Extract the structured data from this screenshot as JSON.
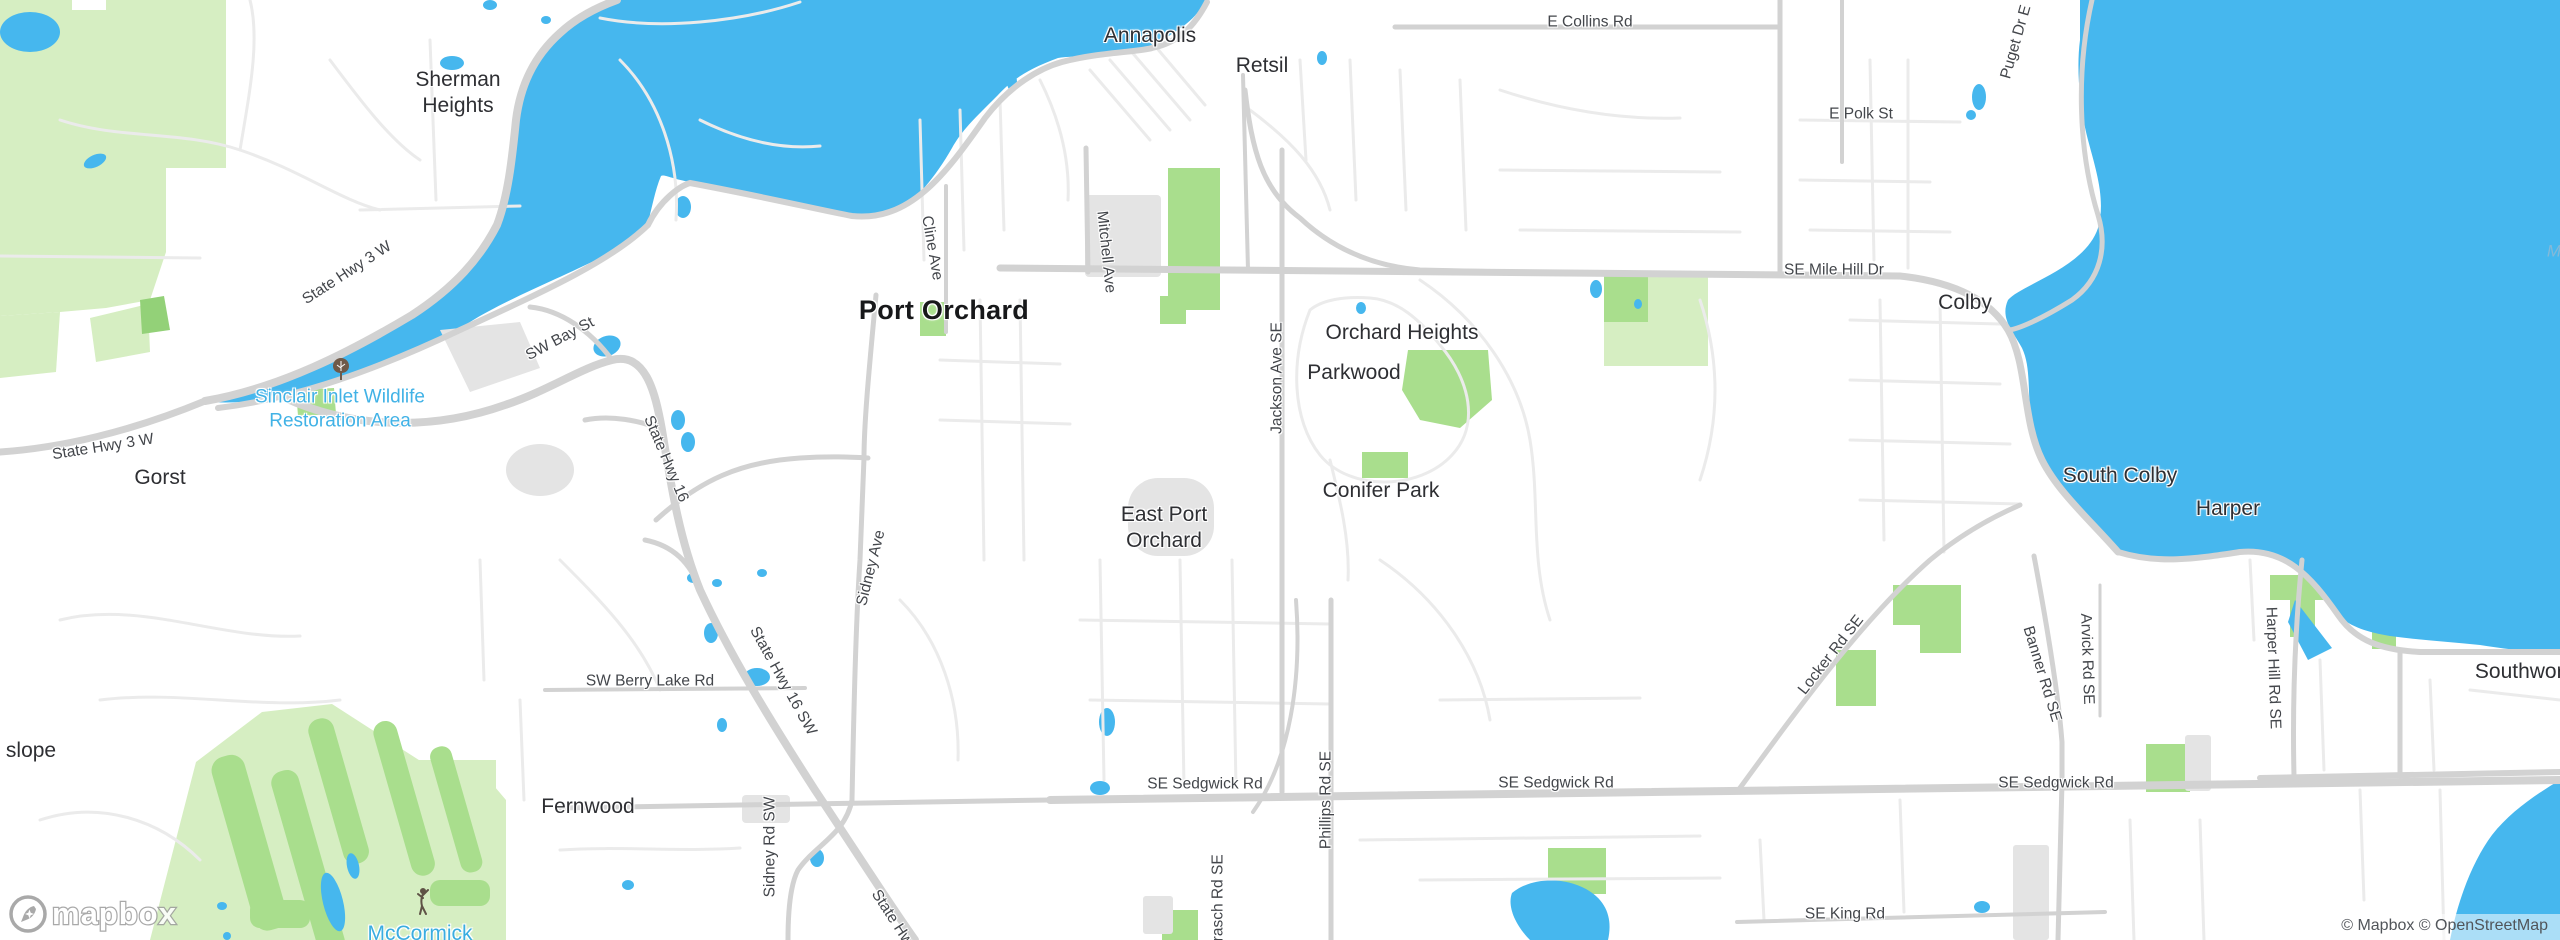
{
  "map": {
    "attribution": "© Mapbox © OpenStreetMap",
    "logo_text": "mapbox",
    "colors": {
      "water": "#46b7ee",
      "park_bright": "#a9de8d",
      "park_light": "#d6eec2",
      "road_major": "#d2d2d2",
      "road_minor": "#ebebeb",
      "built_area": "#e4e4e4",
      "land": "#ffffff",
      "place_label": "#2e2f33",
      "road_label": "#43464b",
      "poi_water_label": "#41b2e6"
    },
    "labels": [
      {
        "name": "place-sherman-heights",
        "text": "Sherman\nHeights",
        "x": 458,
        "y": 93,
        "rot": 0,
        "cls": "place"
      },
      {
        "name": "place-annapolis",
        "text": "Annapolis",
        "x": 1150,
        "y": 36,
        "rot": 0,
        "cls": "place"
      },
      {
        "name": "place-retsil",
        "text": "Retsil",
        "x": 1262,
        "y": 66,
        "rot": 0,
        "cls": "place"
      },
      {
        "name": "place-port-orchard",
        "text": "Port Orchard",
        "x": 944,
        "y": 311,
        "rot": 0,
        "cls": "place-lg"
      },
      {
        "name": "place-gorst",
        "text": "Gorst",
        "x": 160,
        "y": 478,
        "rot": 0,
        "cls": "place"
      },
      {
        "name": "place-east-port-orchard",
        "text": "East Port\nOrchard",
        "x": 1164,
        "y": 528,
        "rot": 0,
        "cls": "place"
      },
      {
        "name": "place-orchard-heights",
        "text": "Orchard Heights",
        "x": 1402,
        "y": 333,
        "rot": 0,
        "cls": "place"
      },
      {
        "name": "place-parkwood",
        "text": "Parkwood",
        "x": 1354,
        "y": 373,
        "rot": 0,
        "cls": "place"
      },
      {
        "name": "place-conifer-park",
        "text": "Conifer Park",
        "x": 1381,
        "y": 491,
        "rot": 0,
        "cls": "place"
      },
      {
        "name": "place-colby",
        "text": "Colby",
        "x": 1965,
        "y": 303,
        "rot": 0,
        "cls": "place"
      },
      {
        "name": "place-south-colby",
        "text": "South Colby",
        "x": 2120,
        "y": 476,
        "rot": 0,
        "cls": "place"
      },
      {
        "name": "place-harper",
        "text": "Harper",
        "x": 2228,
        "y": 509,
        "rot": 0,
        "cls": "place"
      },
      {
        "name": "place-fernwood",
        "text": "Fernwood",
        "x": 588,
        "y": 807,
        "rot": 0,
        "cls": "place"
      },
      {
        "name": "place-slope-cut",
        "text": "slope",
        "x": 31,
        "y": 751,
        "rot": 0,
        "cls": "place"
      },
      {
        "name": "place-southworth",
        "text": "Southworth",
        "x": 2528,
        "y": 672,
        "rot": 0,
        "cls": "place"
      },
      {
        "name": "poi-sinclair-inlet-wildlife",
        "text": "Sinclair Inlet Wildlife\nRestoration Area",
        "x": 340,
        "y": 409,
        "rot": 0,
        "cls": "poi-blue"
      },
      {
        "name": "poi-mccormick",
        "text": "McCormick",
        "x": 420,
        "y": 934,
        "rot": 0,
        "cls": "poi-blue-lg"
      },
      {
        "name": "poi-mccormick-line2",
        "text": "Woods Golf Club",
        "x": 420,
        "y": 961,
        "rot": 0,
        "cls": "poi-blue-lg"
      },
      {
        "name": "road-state-hwy-3-w-upper",
        "text": "State Hwy 3 W",
        "x": 347,
        "y": 273,
        "rot": -33,
        "cls": "road"
      },
      {
        "name": "road-sw-bay-st",
        "text": "SW Bay St",
        "x": 560,
        "y": 339,
        "rot": -28,
        "cls": "road"
      },
      {
        "name": "road-state-hwy-3-w-lower",
        "text": "State Hwy 3 W",
        "x": 103,
        "y": 447,
        "rot": -9,
        "cls": "road"
      },
      {
        "name": "road-state-hwy-16-upper",
        "text": "State Hwy 16",
        "x": 666,
        "y": 459,
        "rot": 67,
        "cls": "road"
      },
      {
        "name": "road-sidney-ave",
        "text": "Sidney Ave",
        "x": 871,
        "y": 568,
        "rot": -76,
        "cls": "road"
      },
      {
        "name": "road-mitchell-ave",
        "text": "Mitchell Ave",
        "x": 1106,
        "y": 252,
        "rot": 84,
        "cls": "road"
      },
      {
        "name": "road-cline-ave",
        "text": "Cline Ave",
        "x": 932,
        "y": 248,
        "rot": 80,
        "cls": "road"
      },
      {
        "name": "road-jackson-ave-se",
        "text": "Jackson Ave SE",
        "x": 1277,
        "y": 378,
        "rot": -90,
        "cls": "road"
      },
      {
        "name": "road-se-mile-hill-dr",
        "text": "SE Mile Hill Dr",
        "x": 1834,
        "y": 270,
        "rot": 0,
        "cls": "road"
      },
      {
        "name": "road-e-collins-rd",
        "text": "E Collins Rd",
        "x": 1590,
        "y": 22,
        "rot": 0,
        "cls": "road"
      },
      {
        "name": "road-e-polk-st",
        "text": "E Polk St",
        "x": 1861,
        "y": 114,
        "rot": 0,
        "cls": "road"
      },
      {
        "name": "road-puget-dr-e",
        "text": "Puget Dr E",
        "x": 2016,
        "y": 42,
        "rot": -74,
        "cls": "road"
      },
      {
        "name": "road-sw-berry-lake-rd",
        "text": "SW Berry Lake Rd",
        "x": 650,
        "y": 681,
        "rot": 0,
        "cls": "road"
      },
      {
        "name": "road-state-hwy-16-sw",
        "text": "State Hwy 16 SW",
        "x": 783,
        "y": 681,
        "rot": 61,
        "cls": "road"
      },
      {
        "name": "road-sidney-rd-sw",
        "text": "Sidney Rd SW",
        "x": 770,
        "y": 847,
        "rot": -90,
        "cls": "road"
      },
      {
        "name": "road-state-hwy-16-lower",
        "text": "State Hwy 16",
        "x": 900,
        "y": 930,
        "rot": 57,
        "cls": "road"
      },
      {
        "name": "road-se-sedgwick-rd-1",
        "text": "SE Sedgwick Rd",
        "x": 1205,
        "y": 784,
        "rot": 0,
        "cls": "road"
      },
      {
        "name": "road-se-sedgwick-rd-2",
        "text": "SE Sedgwick Rd",
        "x": 1556,
        "y": 783,
        "rot": 0,
        "cls": "road"
      },
      {
        "name": "road-se-sedgwick-rd-3",
        "text": "SE Sedgwick Rd",
        "x": 2056,
        "y": 783,
        "rot": 0,
        "cls": "road"
      },
      {
        "name": "road-brasch-rd-se",
        "text": "Brasch Rd SE",
        "x": 1218,
        "y": 903,
        "rot": -90,
        "cls": "road"
      },
      {
        "name": "road-phillips-rd-se",
        "text": "Phillips Rd SE",
        "x": 1326,
        "y": 800,
        "rot": -90,
        "cls": "road"
      },
      {
        "name": "road-se-king-rd",
        "text": "SE King Rd",
        "x": 1845,
        "y": 914,
        "rot": 0,
        "cls": "road"
      },
      {
        "name": "road-locker-rd-se",
        "text": "Locker Rd SE",
        "x": 1831,
        "y": 655,
        "rot": -52,
        "cls": "road"
      },
      {
        "name": "road-banner-rd-se",
        "text": "Banner Rd SE",
        "x": 2042,
        "y": 674,
        "rot": 73,
        "cls": "road"
      },
      {
        "name": "road-arvick-rd-se",
        "text": "Arvick Rd SE",
        "x": 2087,
        "y": 659,
        "rot": 88,
        "cls": "road"
      },
      {
        "name": "road-harper-hill-rd-se",
        "text": "Harper Hill Rd SE",
        "x": 2273,
        "y": 668,
        "rot": 88,
        "cls": "road"
      },
      {
        "name": "water-label-cut",
        "text": "M",
        "x": 2554,
        "y": 251,
        "rot": 0,
        "cls": "water-lbl"
      }
    ]
  }
}
